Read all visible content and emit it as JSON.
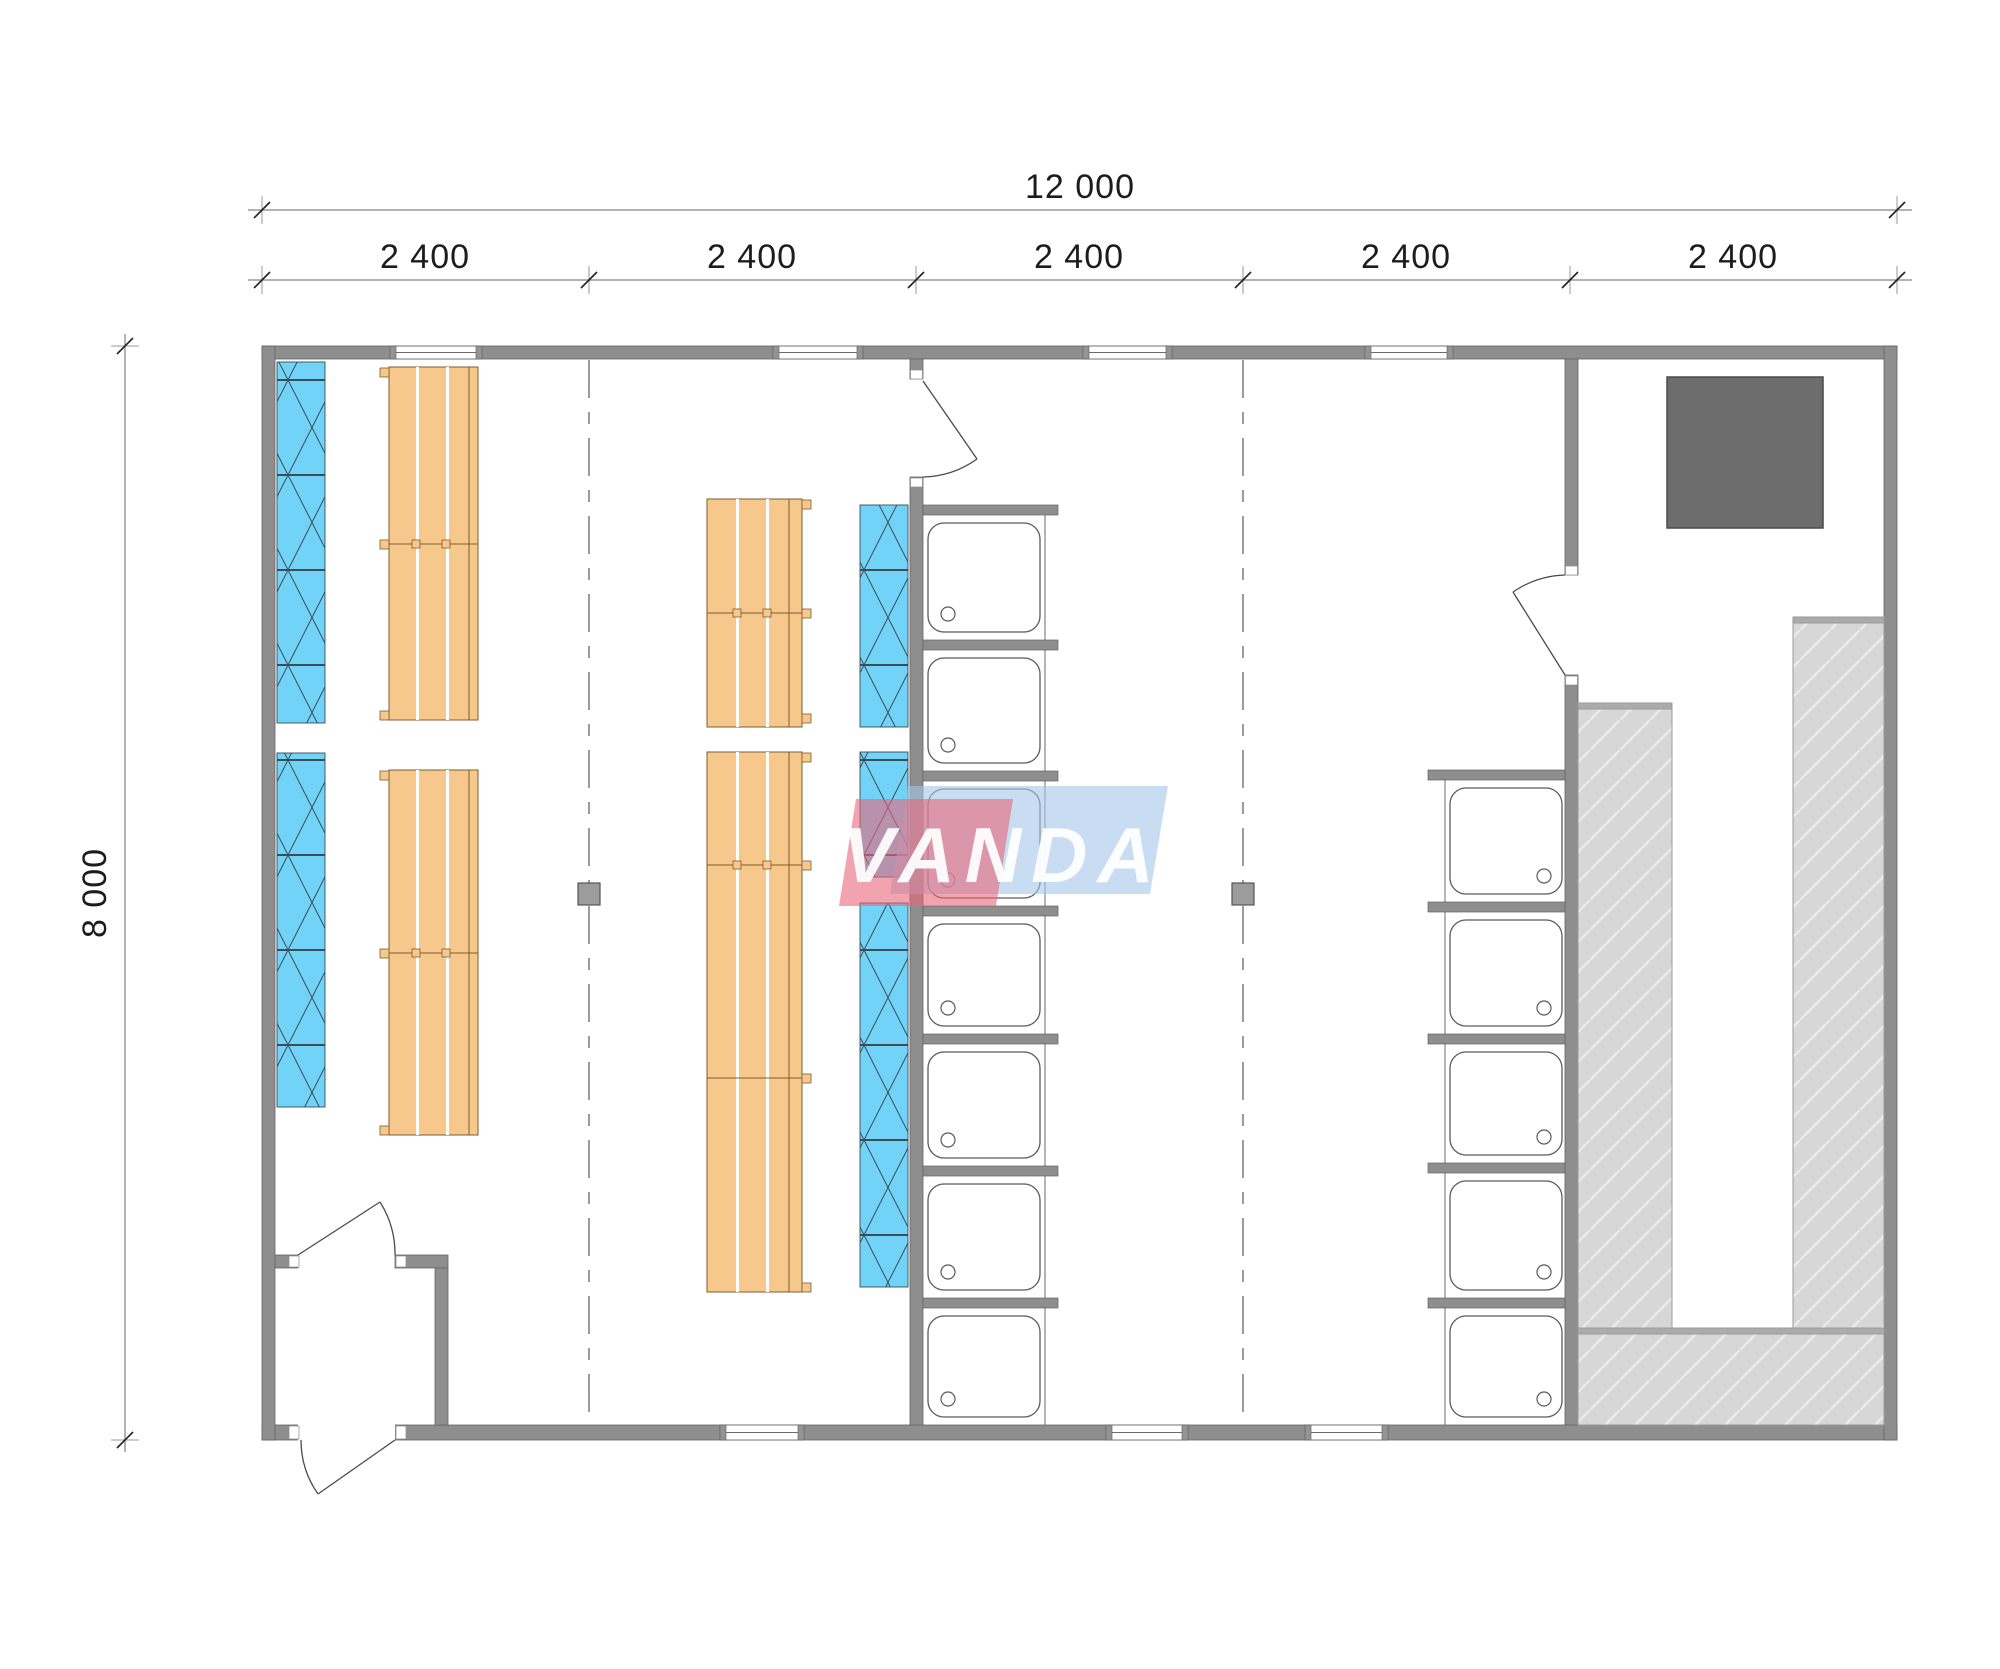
{
  "dimensions": {
    "overall_width_label": "12 000",
    "overall_height_label": "8 000",
    "segment_labels": [
      "2 400",
      "2 400",
      "2 400",
      "2 400",
      "2 400"
    ]
  },
  "logo": {
    "text": "VANDA",
    "red": "#e8687a",
    "blue": "#a5c7ea"
  },
  "colors": {
    "wall": "#8e8e8e",
    "wall_edge": "#646464",
    "radiator": "#71d3f7",
    "bench": "#f7c88c",
    "bench_edge": "#7d5b30",
    "platform": "#d7d7d7",
    "platform_cap": "#ababab",
    "stove": "#6d6d6d",
    "tray": "#ffffff",
    "dashed_line": "#707070",
    "dim_line": "#9a9a9a",
    "dim_text": "#1c1c1c"
  },
  "fixtures": {
    "shower_stalls_center_column": 7,
    "shower_stalls_right_column": 5,
    "bench_groups": 4,
    "radiator_strips": 2,
    "doors": 4,
    "windows_top_wall": 4,
    "windows_bottom_wall": 3,
    "stoves": 1,
    "structural_posts": 2
  }
}
